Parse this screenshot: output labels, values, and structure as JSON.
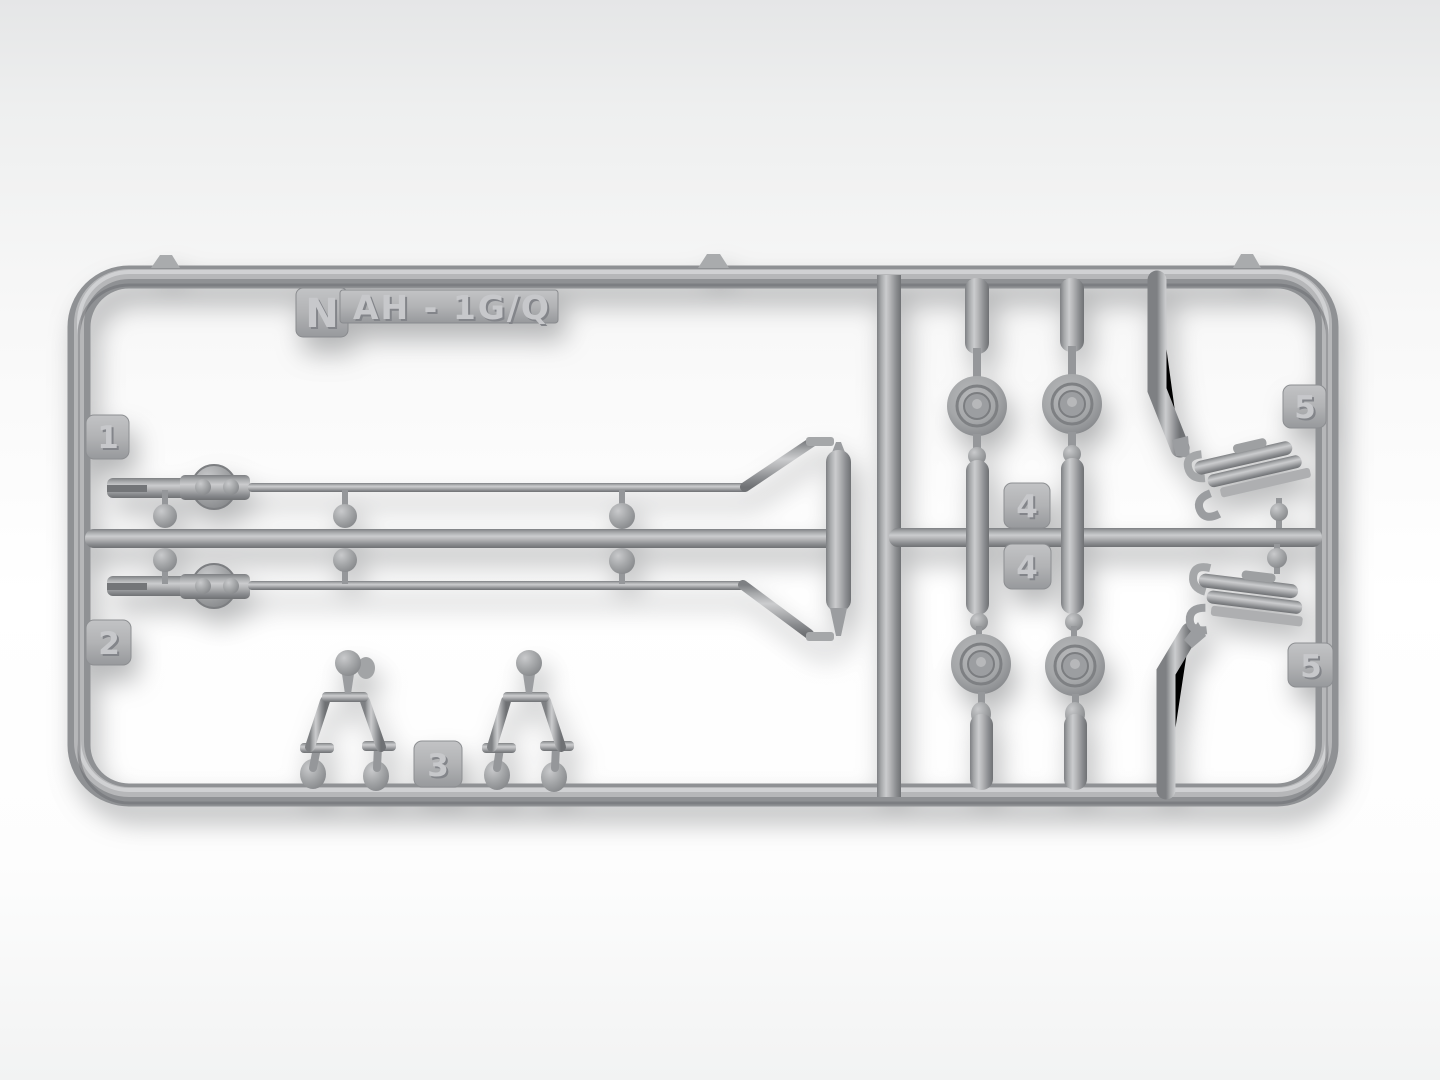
{
  "photo": {
    "subject": "injection-molded-model-kit-sprue",
    "label": {
      "prefix": "N",
      "code": "AH - 1G/Q"
    },
    "part_tags": {
      "t1": "1",
      "t2": "2",
      "t3": "3",
      "t4a": "4",
      "t4b": "4",
      "t5a": "5",
      "t5b": "5"
    },
    "colors": {
      "sprue_base": "#8f9194",
      "sprue_highlight": "#cbccce",
      "sprue_shadow": "#6f7174",
      "plate": "#b3b4b6",
      "background_top": "#e5e6e7",
      "background_bottom": "#f2f3f3"
    }
  }
}
